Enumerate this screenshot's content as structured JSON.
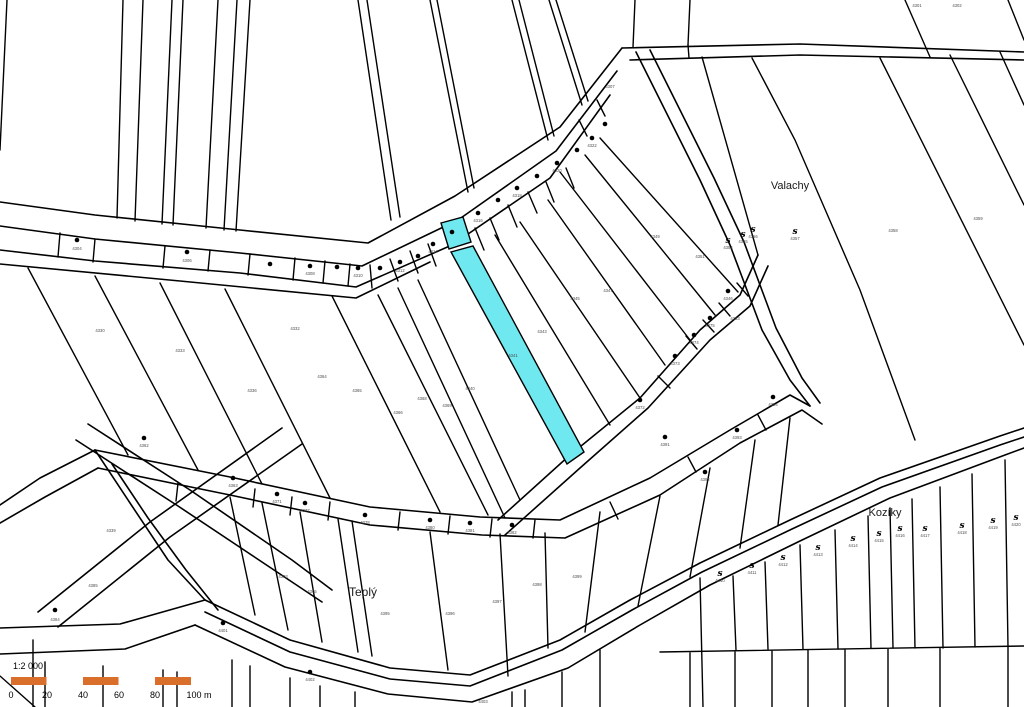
{
  "map": {
    "region_labels": [
      {
        "text": "Valachy",
        "x": 790,
        "y": 189,
        "size": 11
      },
      {
        "text": "Kozíky",
        "x": 885,
        "y": 516,
        "size": 11
      },
      {
        "text": "Teplý",
        "x": 363,
        "y": 596,
        "size": 12
      }
    ],
    "highlight": {
      "color": "#6FE8EF",
      "parcels": [
        {
          "points": "441,223 463,217 471,242 449,249"
        },
        {
          "points": "451,252 473,246 584,452 567,464"
        }
      ]
    },
    "point_symbols": [
      [
        77,
        240
      ],
      [
        187,
        252
      ],
      [
        270,
        264
      ],
      [
        310,
        266
      ],
      [
        337,
        267
      ],
      [
        358,
        268
      ],
      [
        380,
        268
      ],
      [
        400,
        262
      ],
      [
        418,
        256
      ],
      [
        433,
        244
      ],
      [
        452,
        232
      ],
      [
        478,
        213
      ],
      [
        498,
        200
      ],
      [
        517,
        188
      ],
      [
        537,
        176
      ],
      [
        557,
        163
      ],
      [
        577,
        150
      ],
      [
        592,
        138
      ],
      [
        605,
        124
      ],
      [
        144,
        438
      ],
      [
        233,
        478
      ],
      [
        277,
        494
      ],
      [
        305,
        503
      ],
      [
        365,
        515
      ],
      [
        430,
        520
      ],
      [
        470,
        523
      ],
      [
        512,
        525
      ],
      [
        640,
        400
      ],
      [
        675,
        356
      ],
      [
        694,
        335
      ],
      [
        710,
        318
      ],
      [
        728,
        291
      ],
      [
        705,
        472
      ],
      [
        737,
        430
      ],
      [
        773,
        397
      ],
      [
        665,
        437
      ],
      [
        55,
        610
      ],
      [
        223,
        623
      ],
      [
        310,
        672
      ]
    ],
    "shrub_symbols": [
      [
        728,
        240
      ],
      [
        743,
        234
      ],
      [
        753,
        229
      ],
      [
        795,
        231
      ],
      [
        720,
        573
      ],
      [
        752,
        565
      ],
      [
        783,
        557
      ],
      [
        818,
        547
      ],
      [
        853,
        538
      ],
      [
        879,
        533
      ],
      [
        900,
        528
      ],
      [
        925,
        528
      ],
      [
        962,
        525
      ],
      [
        993,
        520
      ],
      [
        1016,
        517
      ]
    ],
    "parcel_numbers": [
      [
        77,
        250,
        "4304"
      ],
      [
        187,
        262,
        "4306"
      ],
      [
        310,
        275,
        "4308"
      ],
      [
        358,
        277,
        "4310"
      ],
      [
        400,
        272,
        "4312"
      ],
      [
        433,
        253,
        "4314"
      ],
      [
        478,
        222,
        "4316"
      ],
      [
        517,
        197,
        "4318"
      ],
      [
        557,
        172,
        "4320"
      ],
      [
        592,
        147,
        "4322"
      ],
      [
        610,
        88,
        "4307"
      ],
      [
        917,
        7,
        "4301"
      ],
      [
        957,
        7,
        "4302"
      ],
      [
        100,
        332,
        "4330"
      ],
      [
        180,
        352,
        "4333"
      ],
      [
        252,
        392,
        "4336"
      ],
      [
        295,
        330,
        "4332"
      ],
      [
        322,
        378,
        "4364"
      ],
      [
        357,
        392,
        "4365"
      ],
      [
        398,
        414,
        "4366"
      ],
      [
        422,
        400,
        "4368"
      ],
      [
        447,
        407,
        "4369"
      ],
      [
        513,
        357,
        "4341"
      ],
      [
        542,
        333,
        "4343"
      ],
      [
        470,
        390,
        "4340"
      ],
      [
        575,
        300,
        "4345"
      ],
      [
        608,
        292,
        "4347"
      ],
      [
        655,
        238,
        "4349"
      ],
      [
        700,
        258,
        "4351"
      ],
      [
        735,
        320,
        "4353"
      ],
      [
        640,
        409,
        "4372"
      ],
      [
        675,
        365,
        "4373"
      ],
      [
        694,
        344,
        "4374"
      ],
      [
        710,
        327,
        "4375"
      ],
      [
        728,
        300,
        "4346"
      ],
      [
        705,
        481,
        "4392"
      ],
      [
        737,
        439,
        "4393"
      ],
      [
        773,
        406,
        "4394"
      ],
      [
        665,
        446,
        "4391"
      ],
      [
        728,
        249,
        "4354"
      ],
      [
        743,
        243,
        "4355"
      ],
      [
        753,
        238,
        "4356"
      ],
      [
        795,
        240,
        "4357"
      ],
      [
        893,
        232,
        "4358"
      ],
      [
        978,
        220,
        "4359"
      ],
      [
        144,
        447,
        "4362"
      ],
      [
        233,
        487,
        "4363"
      ],
      [
        277,
        503,
        "4371"
      ],
      [
        305,
        512,
        "4377"
      ],
      [
        365,
        524,
        "4378"
      ],
      [
        430,
        529,
        "4380"
      ],
      [
        470,
        532,
        "4381"
      ],
      [
        512,
        534,
        "4382"
      ],
      [
        55,
        621,
        "4384"
      ],
      [
        93,
        587,
        "4385"
      ],
      [
        111,
        532,
        "4339"
      ],
      [
        283,
        578,
        "4303"
      ],
      [
        312,
        593,
        "4305"
      ],
      [
        385,
        615,
        "4395"
      ],
      [
        450,
        615,
        "4396"
      ],
      [
        497,
        603,
        "4397"
      ],
      [
        537,
        586,
        "4398"
      ],
      [
        577,
        578,
        "4399"
      ],
      [
        223,
        632,
        "4401"
      ],
      [
        310,
        681,
        "4402"
      ],
      [
        483,
        703,
        "4403"
      ],
      [
        720,
        582,
        "4410"
      ],
      [
        752,
        574,
        "4411"
      ],
      [
        783,
        566,
        "4412"
      ],
      [
        818,
        556,
        "4413"
      ],
      [
        853,
        547,
        "4414"
      ],
      [
        879,
        542,
        "4415"
      ],
      [
        900,
        537,
        "4416"
      ],
      [
        925,
        537,
        "4417"
      ],
      [
        962,
        534,
        "4418"
      ],
      [
        993,
        529,
        "4419"
      ],
      [
        1016,
        526,
        "4420"
      ]
    ]
  },
  "scale_bar": {
    "ratio_label": "1:2 000",
    "ticks": [
      "0",
      "20",
      "40",
      "60",
      "80",
      "100 m"
    ],
    "bar_color": "#D96F2B",
    "bar_x": 11,
    "bar_y": 677,
    "segment_width": 36,
    "bar_height": 8
  }
}
